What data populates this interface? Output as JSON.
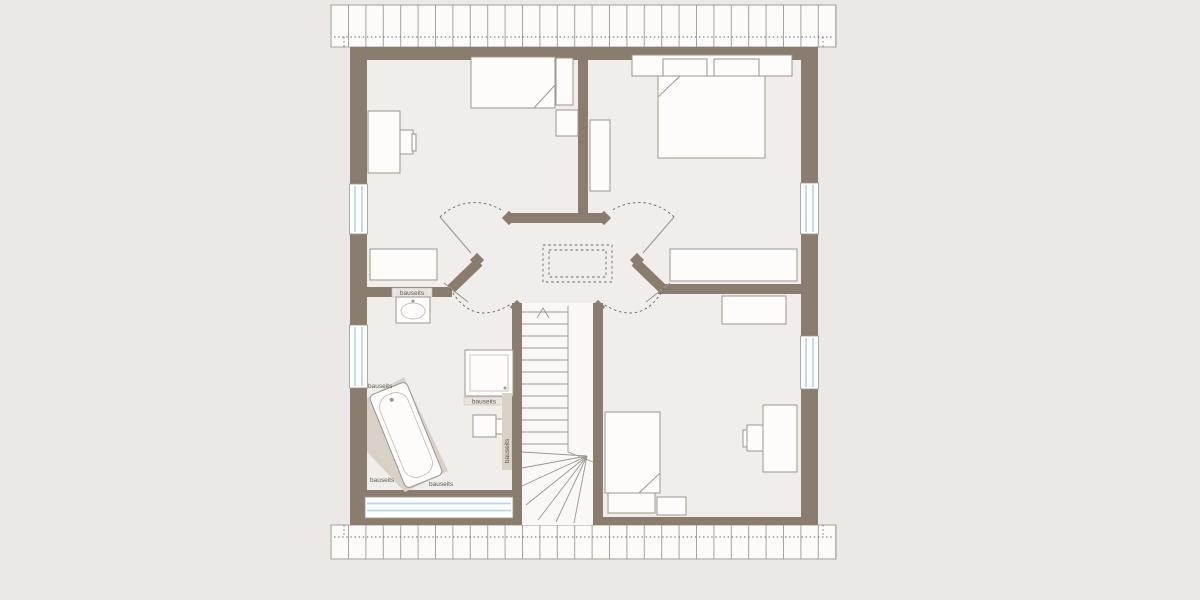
{
  "plan": {
    "type": "floor-plan",
    "labels": {
      "wall_strip": "bauseits",
      "above_tub": "bauseits",
      "below_tub_left": "bauseits",
      "below_tub_right": "bauseits",
      "shower_strip": "bauseits",
      "stair_side_vertical": "bauseits"
    },
    "icons": {
      "stairs_direction": "up-arrow"
    }
  },
  "colors": {
    "background": "#ece8e5",
    "floor": "#f1edea",
    "stairwell": "#faf8f6",
    "wall": "#8a7c6e",
    "furniture": "#fdfcfb",
    "line": "#9c968e",
    "line_soft": "#c6c0b8",
    "glass": "#b9d6e3",
    "platform": "#d8d1c8",
    "strip": "#e9e4df",
    "roof": "#fcfbfa",
    "hatch": "#a8a19a",
    "dash": "#6b655e",
    "label": "#5f584f"
  }
}
